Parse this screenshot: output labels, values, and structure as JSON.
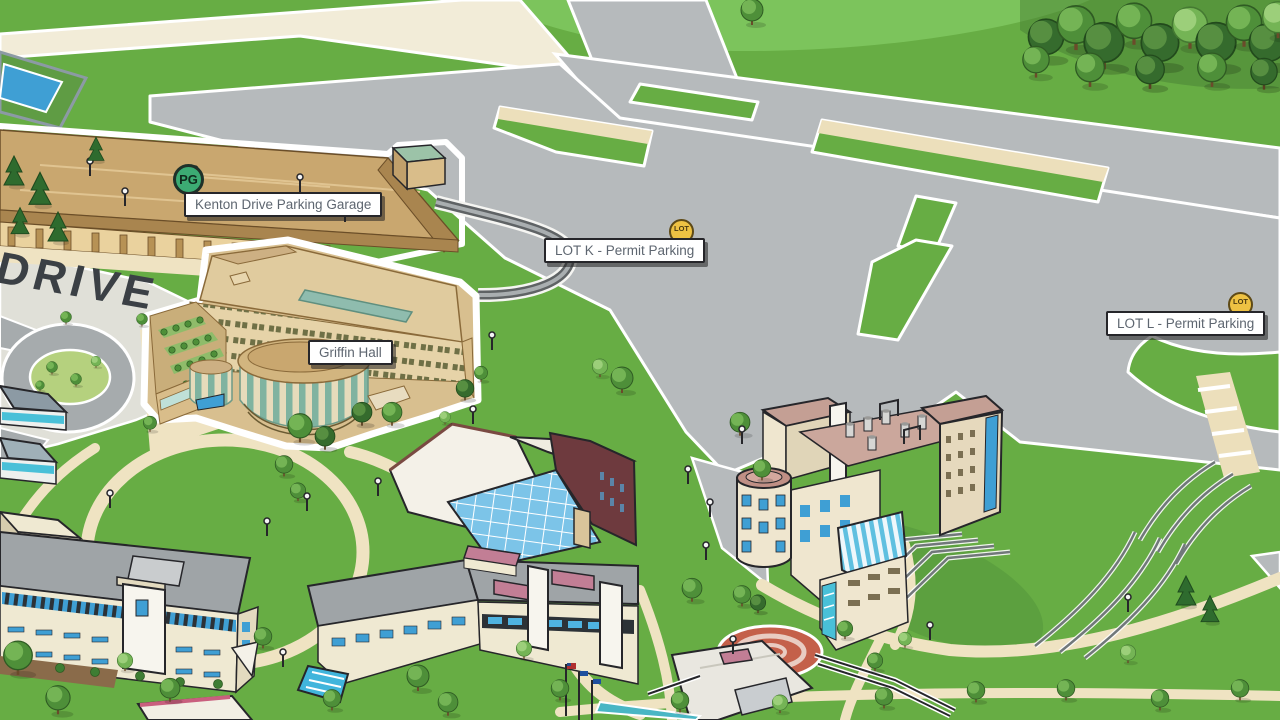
{
  "road_label": "DRIVE",
  "markers": {
    "parking_garage": {
      "badge": "PG",
      "label": "Kenton Drive Parking Garage"
    },
    "griffin_hall": {
      "label": "Griffin Hall"
    },
    "lot_k": {
      "badge": "LOT",
      "label": "LOT K - Permit Parking"
    },
    "lot_l": {
      "badge": "LOT",
      "label": "LOT L - Permit Parking"
    }
  },
  "colors": {
    "grass": "#67ad44",
    "grass_dark": "#4f9636",
    "grass_light": "#7cc45c",
    "pavement": "#b6babc",
    "sidewalk_cream": "#efe3c2",
    "road_cream": "#f2ecd8",
    "garage_tan": "#c9a76f",
    "building_cream": "#efe9d2",
    "roof_gray": "#9fa4a7",
    "window_blue": "#3f9fd4",
    "accent_maroon": "#6e3a3e",
    "accent_pink": "#c27e95",
    "griffin_green": "#7fb3a0",
    "track_red": "#c4604a",
    "badge_green": "#3cab73",
    "badge_yellow": "#eec243",
    "label_text": "#5e6670"
  }
}
